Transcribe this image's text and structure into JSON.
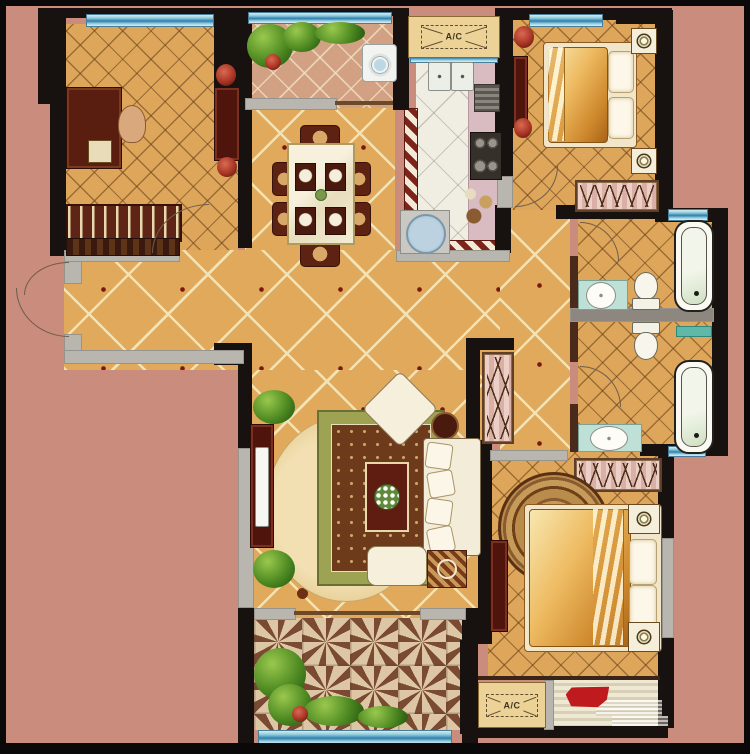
{
  "plan": {
    "title": "apartment-floor-plan",
    "ac_top_label": "A/C",
    "ac_bottom_label": "A/C"
  },
  "watermark": {
    "present": true,
    "color": "#bf1a1d",
    "legible_text": ""
  },
  "colors": {
    "exterior": "#ca8c7c",
    "wall": "#17110f",
    "window_glass": "#4f9cc0",
    "floor_tile_tan": "#dfa85c",
    "tile_grout_cream": "#f2e2b4",
    "kitchen_floor": "#f0ede3",
    "checker_red": "#7d241a",
    "furniture_dark_red": "#4f150c",
    "rug_green": "#9ea354",
    "rug_brown": "#6e3a1c",
    "sill_gray": "#b9b6af",
    "bath_counter_aqua": "#bfe0d6"
  },
  "rooms": [
    {
      "name": "study"
    },
    {
      "name": "north-balcony"
    },
    {
      "name": "kitchen"
    },
    {
      "name": "north-bedroom"
    },
    {
      "name": "dining-area"
    },
    {
      "name": "entry-hall"
    },
    {
      "name": "corridor"
    },
    {
      "name": "north-bathroom"
    },
    {
      "name": "south-bathroom"
    },
    {
      "name": "living-room"
    },
    {
      "name": "south-bedroom"
    },
    {
      "name": "south-balcony"
    },
    {
      "name": "laundry-deck"
    },
    {
      "name": "ac-platform-north"
    },
    {
      "name": "ac-platform-south"
    }
  ]
}
